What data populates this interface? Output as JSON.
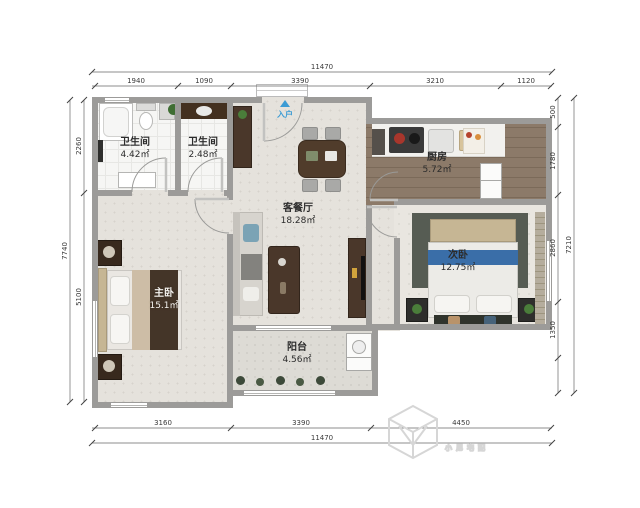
{
  "plan": {
    "entry_label": "入户",
    "rooms": [
      {
        "id": "bath1",
        "name": "卫生间",
        "area": "4.42㎡"
      },
      {
        "id": "bath2",
        "name": "卫生间",
        "area": "2.48㎡"
      },
      {
        "id": "living",
        "name": "客餐厅",
        "area": "18.28㎡"
      },
      {
        "id": "kitchen",
        "name": "厨房",
        "area": "5.72㎡"
      },
      {
        "id": "bedroom2",
        "name": "次卧",
        "area": "12.75㎡"
      },
      {
        "id": "master",
        "name": "主卧",
        "area": "15.1㎡"
      },
      {
        "id": "balcony",
        "name": "阳台",
        "area": "4.56㎡"
      }
    ]
  },
  "dimensions": {
    "top": {
      "total": "11470",
      "segments": [
        "1940",
        "1090",
        "3390",
        "3210",
        "1120"
      ]
    },
    "bottom": {
      "total": "11470",
      "segments": [
        "3160",
        "3390",
        "4450"
      ]
    },
    "left": {
      "total": "7740",
      "segments": [
        "2260",
        "5100"
      ]
    },
    "right": {
      "total": "7210",
      "segments": [
        "500",
        "1780",
        "2860",
        "1350"
      ]
    }
  },
  "watermark": {
    "text": "小尼宅配"
  },
  "colors": {
    "wall": "#9c9b99",
    "entry_marker": "#3b9bd4",
    "bed_band_blue": "#3a6ea8",
    "furniture_wood": "#4a372a",
    "watermark_gray": "#d6d6d6"
  }
}
